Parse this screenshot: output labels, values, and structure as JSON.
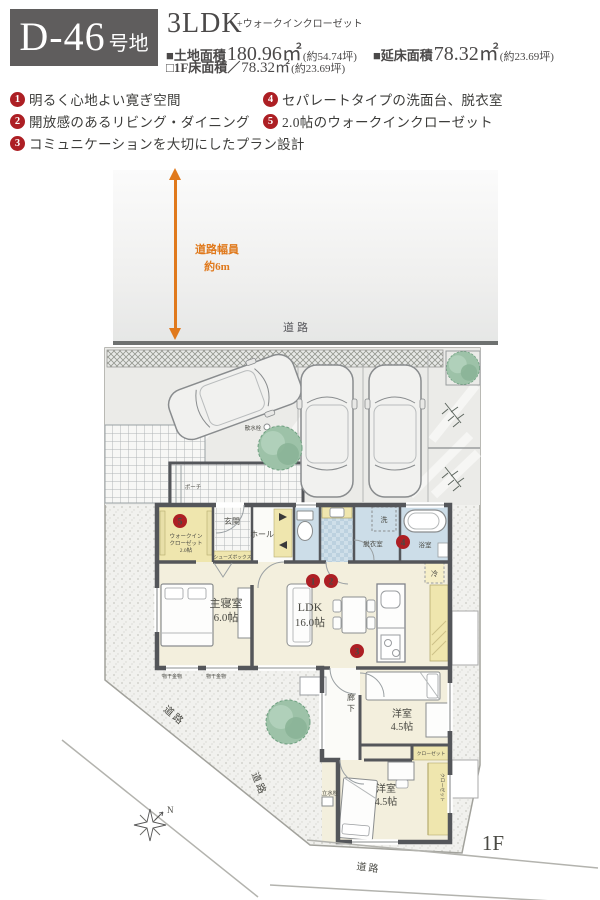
{
  "header": {
    "lot": "D-46",
    "lot_suffix": "号地",
    "plan": "3LDK",
    "plan_note": "+ウォークインクローゼット",
    "land": {
      "label": "■土地面積",
      "value": "180.96㎡",
      "tsubo": "(約54.74坪)"
    },
    "total": {
      "label": "■延床面積",
      "value": "78.32㎡",
      "tsubo": "(約23.69坪)"
    },
    "f1": {
      "label": "□1F床面積／",
      "value": "78.32㎡",
      "tsubo": "(約23.69坪)"
    }
  },
  "features": [
    {
      "num": "1",
      "text": "明るく心地よい寛ぎ空間"
    },
    {
      "num": "2",
      "text": "開放感のあるリビング・ダイニング"
    },
    {
      "num": "3",
      "text": "コミュニケーションを大切にしたプラン設計"
    },
    {
      "num": "4",
      "text": "セパレートタイプの洗面台、脱衣室"
    },
    {
      "num": "5",
      "text": "2.0帖のウォークインクローゼット"
    }
  ],
  "site": {
    "road_label": "道路",
    "road_width_1": "道路幅員",
    "road_width_2": "約6m",
    "floor_label": "1F",
    "compass_n": "N"
  },
  "rooms": {
    "wic_1": "ウォークイン",
    "wic_2": "クローゼット",
    "wic_3": "2.0帖",
    "genkan": "玄関",
    "hall": "ホール",
    "shoes": "シューズボックス",
    "washer": "洗",
    "datsui": "脱衣室",
    "bath": "浴室",
    "fridge": "冷",
    "master_name": "主寝室",
    "master_size": "6.0帖",
    "ldk_name": "LDK",
    "ldk_size": "16.0帖",
    "corridor_1": "廊",
    "corridor_2": "下",
    "west_name": "洋室",
    "west_size": "4.5帖",
    "closet": "クローゼット",
    "monohoshi": "物干金物",
    "tap": "立水栓",
    "sansui": "散水栓",
    "porch": "ポーチ"
  }
}
